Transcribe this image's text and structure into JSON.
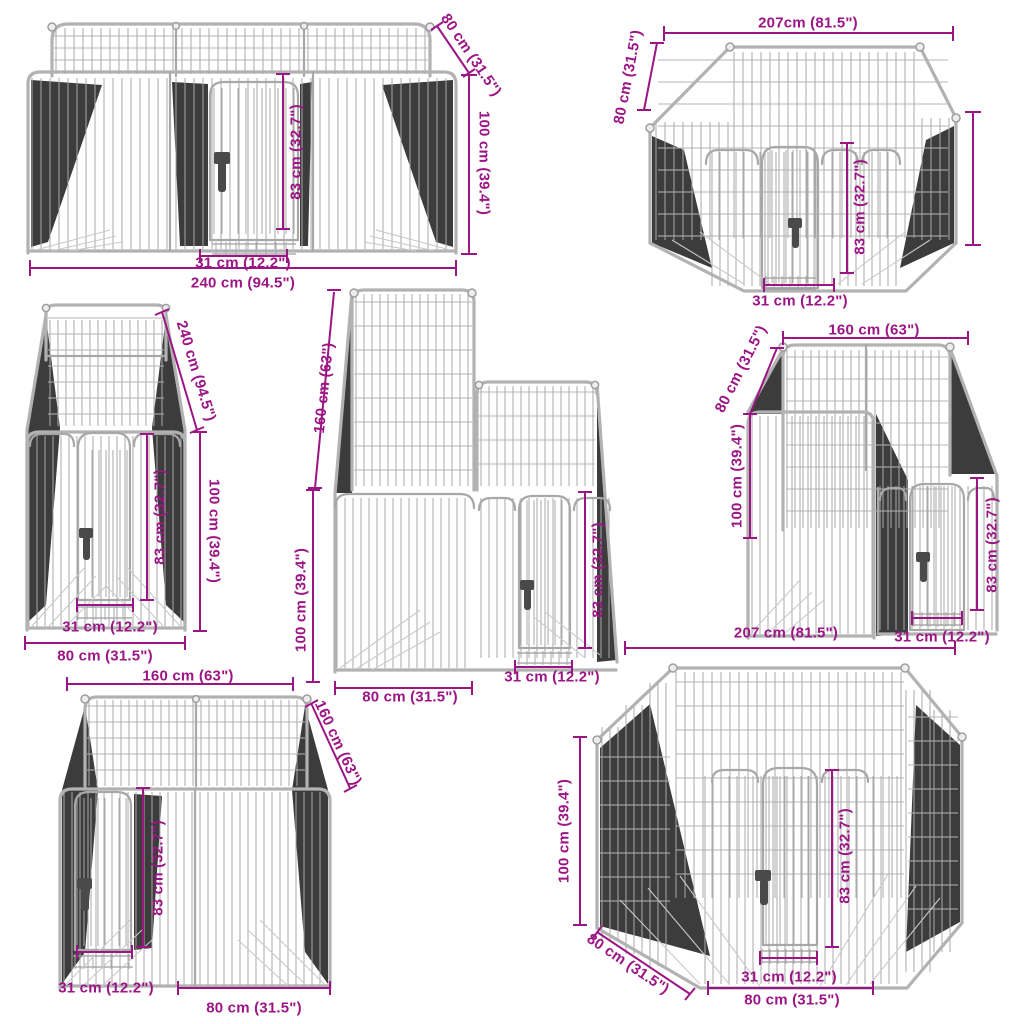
{
  "diagram": {
    "type": "product-dimension-diagram",
    "subject": "dog playpen panel configurations",
    "dimension_color": "#9C1585",
    "wire_color": "#a9a9a9"
  },
  "figures": [
    {
      "name": "playpen-rectangle-240x80",
      "labels": [
        "80 cm (31.5\")",
        "100 cm (39.4\")",
        "83 cm (32.7\")",
        "31 cm (12.2\")",
        "240 cm (94.5\")"
      ]
    },
    {
      "name": "playpen-octagon-207-small",
      "labels": [
        "207cm (81.5\")",
        "80 cm (31.5\")",
        "83 cm (32.7\")",
        "31 cm (12.2\")"
      ]
    },
    {
      "name": "playpen-narrow-240-deep",
      "labels": [
        "240 cm (94.5\")",
        "100 cm (39.4\")",
        "83 cm (32.7\")",
        "31 cm (12.2\")",
        "80 cm (31.5\")"
      ]
    },
    {
      "name": "playpen-tall-back-160",
      "labels": [
        "160 cm (63\")",
        "100 cm (39.4\")",
        "83 cm (32.7\")",
        "31 cm (12.2\")",
        "80 cm (31.5\")"
      ]
    },
    {
      "name": "playpen-l-shape-160x80",
      "labels": [
        "160 cm (63\")",
        "80 cm (31.5\")",
        "100 cm (39.4\")",
        "83 cm (32.7\")",
        "31 cm (12.2\")"
      ]
    },
    {
      "name": "playpen-square-160x160",
      "labels": [
        "160 cm (63\")",
        "160 cm (63\")",
        "83 cm (32.7\")",
        "31 cm (12.2\")",
        "80 cm (31.5\")"
      ]
    },
    {
      "name": "playpen-octagon-207-large",
      "labels": [
        "207 cm (81.5\")",
        "100 cm (39.4\")",
        "80 cm (31.5\")",
        "83 cm (32.7\")",
        "31 cm (12.2\")",
        "80 cm (31.5\")"
      ]
    }
  ]
}
